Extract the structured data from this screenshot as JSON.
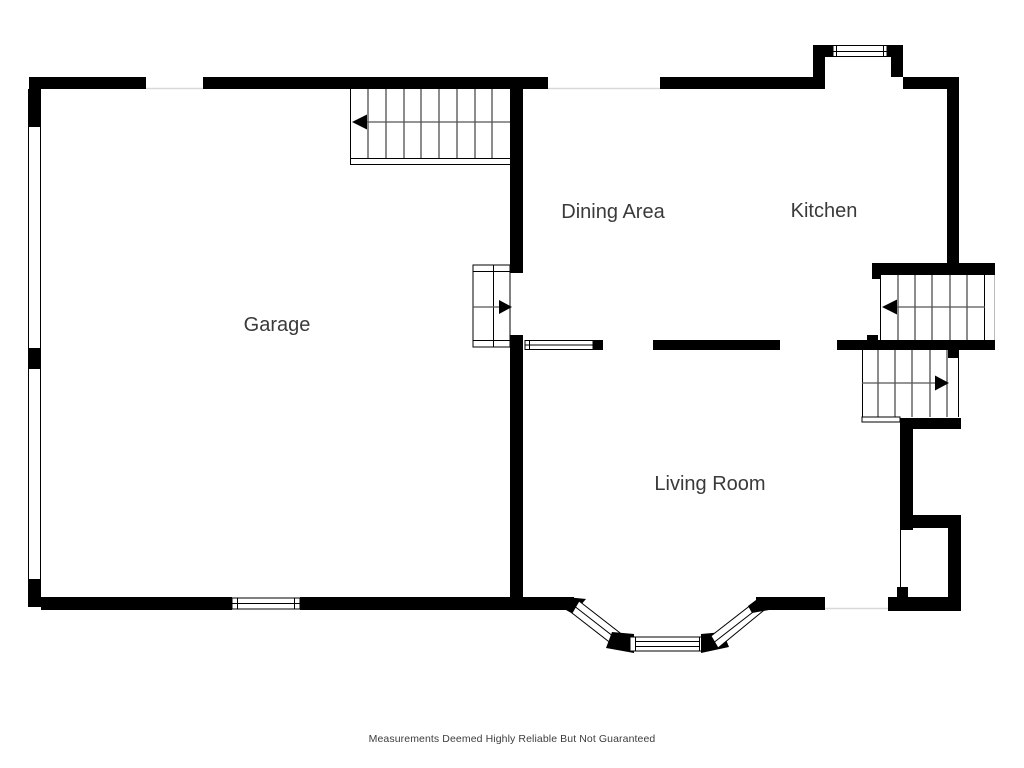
{
  "floorplan": {
    "labels": {
      "garage": "Garage",
      "dining": "Dining Area",
      "kitchen": "Kitchen",
      "living": "Living Room"
    },
    "footer": "Measurements Deemed Highly Reliable But Not Guaranteed",
    "colors": {
      "background": "#ffffff",
      "wall": "#000000",
      "label_text": "#3a3a3a",
      "stair_run_line": "#555555",
      "opening_line": "#d9d9d9"
    },
    "stairs": [
      {
        "location": "top-center",
        "arrow_direction": "left"
      },
      {
        "location": "garage-entry-steps",
        "arrow_direction": "right"
      },
      {
        "location": "right-upper-flight",
        "arrow_direction": "left"
      },
      {
        "location": "right-lower-flight",
        "arrow_direction": "right"
      }
    ],
    "windows": [
      "kitchen-bump-out",
      "dining-interior",
      "garage-bottom",
      "bay-left",
      "bay-center",
      "bay-right"
    ]
  }
}
